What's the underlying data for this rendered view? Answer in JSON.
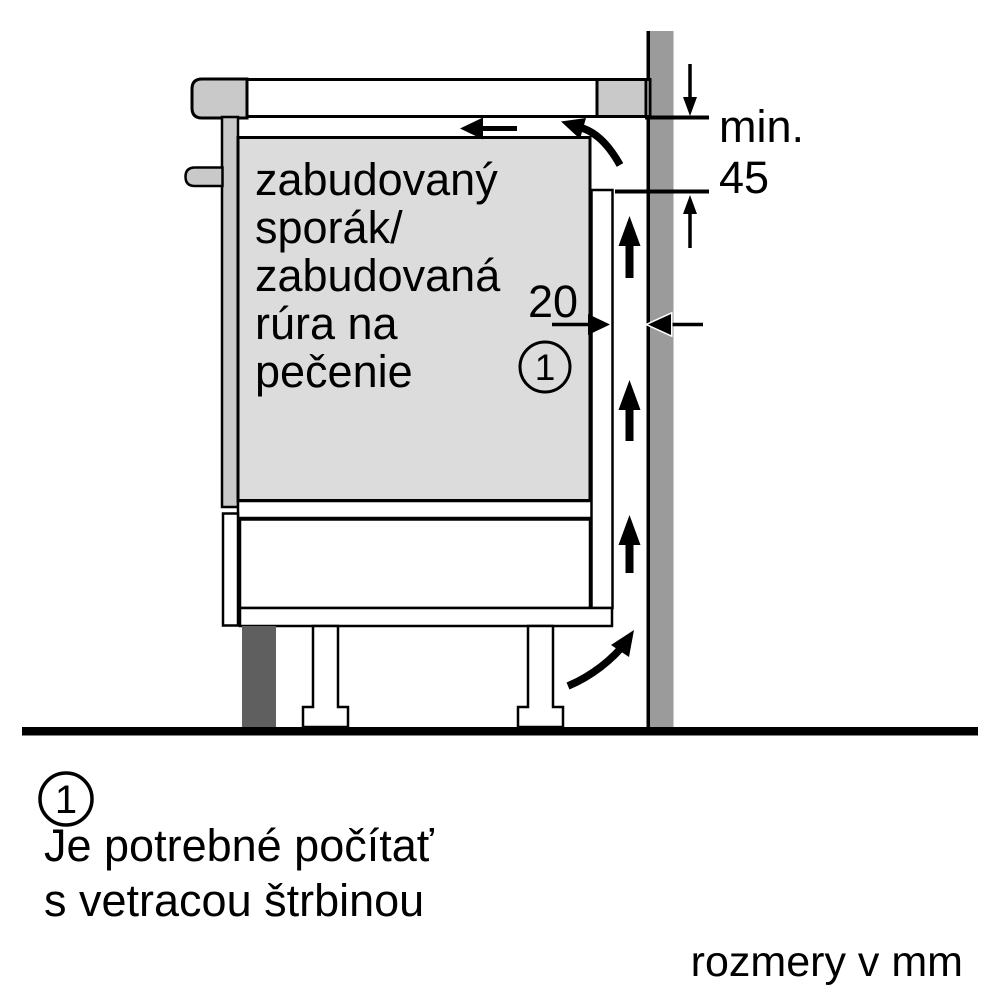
{
  "colors": {
    "wall_gray": "#9b9b9b",
    "appliance_gray": "#dcdcdc",
    "trim_gray": "#c9c9c9",
    "plinth_gray": "#5f5f5f",
    "line_black": "#000000",
    "background": "#ffffff"
  },
  "diagram": {
    "appliance_label": {
      "lines": [
        "zabudovaný",
        "sporák/",
        "zabudovaná",
        "rúra na",
        "pečenie"
      ]
    },
    "dim_min": {
      "label": "min.",
      "value": "45"
    },
    "dim_gap": {
      "value": "20"
    },
    "callout": {
      "number": "1"
    }
  },
  "legend": {
    "marker": "1",
    "lines": [
      "Je potrebné počítať",
      "s vetracou štrbinou"
    ]
  },
  "footer": {
    "units_note": "rozmery v mm"
  }
}
